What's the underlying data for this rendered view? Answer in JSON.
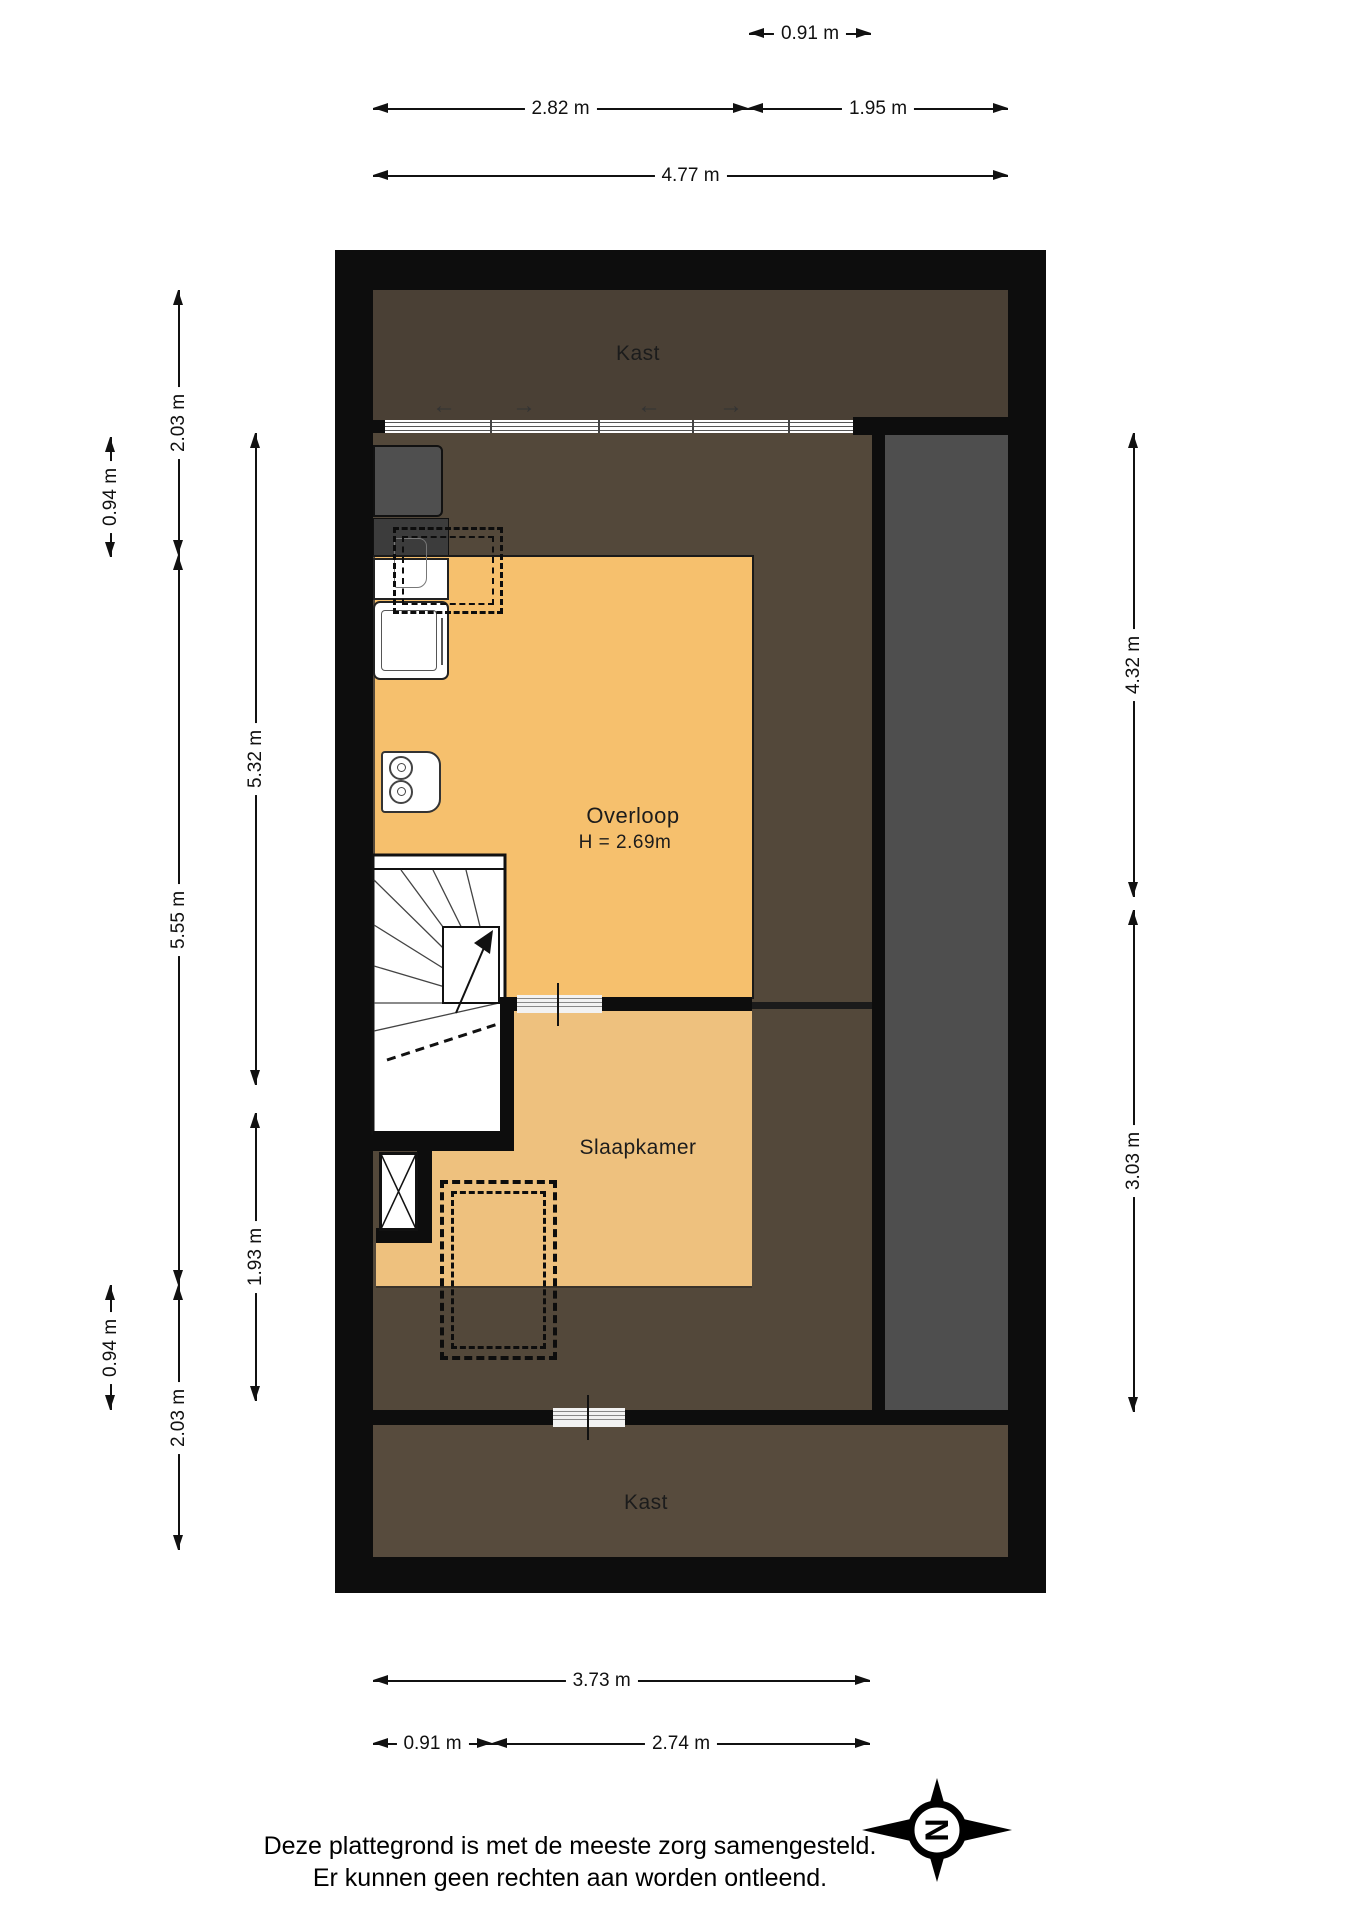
{
  "title": "floor-plan",
  "rooms": {
    "kast_top": "Kast",
    "overloop": "Overloop",
    "overloop_height": "H = 2.69m",
    "slaapkamer": "Slaapkamer",
    "kast_bottom": "Kast"
  },
  "dims": {
    "top_091": "0.91 m",
    "top_282": "2.82 m",
    "top_195": "1.95 m",
    "top_477": "4.77 m",
    "left_094_top": "0.94 m",
    "left_203_top": "2.03 m",
    "left_532": "5.32 m",
    "left_555": "5.55 m",
    "left_193": "1.93 m",
    "left_094_bottom": "0.94 m",
    "left_203_bottom": "2.03 m",
    "right_432": "4.32 m",
    "right_303": "3.03 m",
    "bottom_373": "3.73 m",
    "bottom_091": "0.91 m",
    "bottom_274": "2.74 m"
  },
  "glyphs": {
    "arrow_left": "←",
    "arrow_right": "→"
  },
  "compass": {
    "north_label": "N"
  },
  "footer": {
    "line1": "Deze plattegrond is met de meeste zorg samengesteld.",
    "line2": "Er kunnen geen rechten aan worden ontleend."
  },
  "colors": {
    "wall": "#0d0d0d",
    "kast_top": "#4a4035",
    "floor": "#53483a",
    "kast_bottom": "#574b3d",
    "gray_zone": "#4e4e4e",
    "overloop": "#f6c06d",
    "slaapkamer": "#eec17e"
  }
}
